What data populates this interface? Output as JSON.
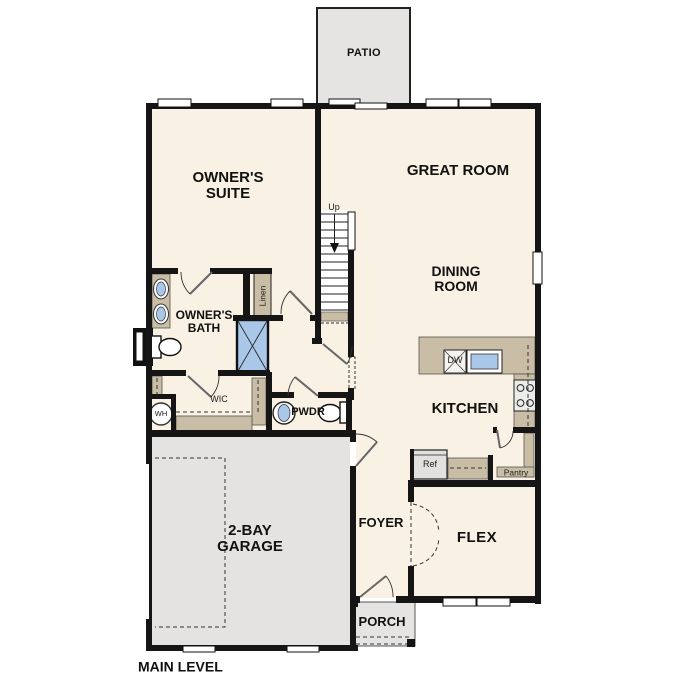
{
  "plan": {
    "title": "MAIN LEVEL",
    "labels": {
      "patio": "PATIO",
      "owners_suite_1": "OWNER'S",
      "owners_suite_2": "SUITE",
      "great_room": "GREAT ROOM",
      "dining_1": "DINING",
      "dining_2": "ROOM",
      "owners_bath_1": "OWNER'S",
      "owners_bath_2": "BATH",
      "kitchen": "KITCHEN",
      "wic": "WIC",
      "powder": "PWDR",
      "garage_1": "2-BAY",
      "garage_2": "GARAGE",
      "foyer": "FOYER",
      "flex": "FLEX",
      "porch": "PORCH",
      "up": "Up",
      "linen": "Linen",
      "water_heater": "WH",
      "dishwasher": "DW",
      "refrigerator": "Ref",
      "pantry": "Pantry"
    },
    "colors": {
      "floor": "#f8f1e4",
      "outdoor_concrete": "#e5e4e2",
      "wall": "#151515",
      "cabinetry_tan": "#c9bda5",
      "fixture_blue": "#a9c7e8"
    }
  }
}
